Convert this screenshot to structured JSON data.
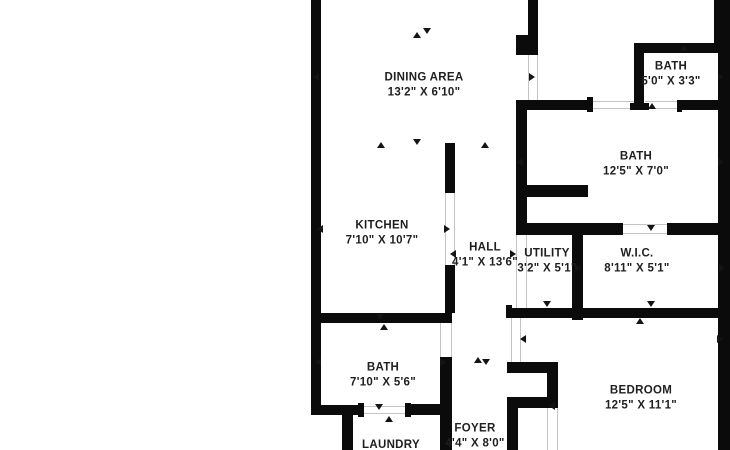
{
  "canvas": {
    "width": 730,
    "height": 450,
    "background": "#ffffff",
    "wall_color": "#0b0b0b",
    "door_line_color": "#c4c4c4",
    "text_color": "#1f1f1f"
  },
  "rooms": [
    {
      "id": "dining-area",
      "name": "DINING AREA",
      "dims": "13'2\" X 6'10\"",
      "cx": 424,
      "cy": 85
    },
    {
      "id": "kitchen",
      "name": "KITCHEN",
      "dims": "7'10\" X 10'7\"",
      "cx": 382,
      "cy": 233
    },
    {
      "id": "hall",
      "name": "HALL",
      "dims": "4'1\" X 13'6\"",
      "cx": 485,
      "cy": 255
    },
    {
      "id": "utility",
      "name": "UTILITY",
      "dims": "3'2\" X 5'1\"",
      "cx": 547,
      "cy": 261
    },
    {
      "id": "wic",
      "name": "W.I.C.",
      "dims": "8'11\" X 5'1\"",
      "cx": 637,
      "cy": 261
    },
    {
      "id": "bath-top-right",
      "name": "BATH",
      "dims": "5'0\" X 3'3\"",
      "cx": 671,
      "cy": 74
    },
    {
      "id": "bath-right",
      "name": "BATH",
      "dims": "12'5\" X 7'0\"",
      "cx": 636,
      "cy": 164
    },
    {
      "id": "bath-left",
      "name": "BATH",
      "dims": "7'10\" X 5'6\"",
      "cx": 383,
      "cy": 375
    },
    {
      "id": "bedroom",
      "name": "BEDROOM",
      "dims": "12'5\" X 11'1\"",
      "cx": 641,
      "cy": 398
    },
    {
      "id": "foyer",
      "name": "FOYER",
      "dims": "4'4\" X 8'0\"",
      "cx": 475,
      "cy": 436
    },
    {
      "id": "laundry",
      "name": "LAUNDRY",
      "dims": "",
      "cx": 391,
      "cy": 445
    }
  ],
  "walls": [
    [
      311,
      0,
      10,
      415
    ],
    [
      311,
      405,
      52,
      10
    ],
    [
      342,
      405,
      11,
      45
    ],
    [
      407,
      404,
      45,
      11
    ],
    [
      440,
      404,
      12,
      46
    ],
    [
      311,
      313,
      141,
      10
    ],
    [
      445,
      143,
      10,
      50
    ],
    [
      445,
      265,
      10,
      48
    ],
    [
      440,
      357,
      12,
      48
    ],
    [
      528,
      0,
      10,
      55
    ],
    [
      516,
      35,
      22,
      20
    ],
    [
      516,
      100,
      75,
      10
    ],
    [
      634,
      43,
      10,
      67
    ],
    [
      634,
      43,
      96,
      10
    ],
    [
      714,
      0,
      16,
      53
    ],
    [
      718,
      0,
      12,
      450
    ],
    [
      682,
      100,
      48,
      10
    ],
    [
      516,
      100,
      11,
      135
    ],
    [
      518,
      185,
      70,
      12
    ],
    [
      516,
      223,
      107,
      12
    ],
    [
      667,
      223,
      63,
      12
    ],
    [
      572,
      223,
      11,
      97
    ],
    [
      511,
      308,
      219,
      10
    ],
    [
      507,
      362,
      51,
      11
    ],
    [
      547,
      362,
      11,
      46
    ],
    [
      507,
      397,
      51,
      11
    ],
    [
      507,
      397,
      11,
      53
    ],
    [
      587,
      97,
      6,
      15
    ],
    [
      630,
      103,
      19,
      7
    ],
    [
      677,
      100,
      5,
      12
    ],
    [
      358,
      403,
      6,
      14
    ],
    [
      405,
      403,
      6,
      14
    ],
    [
      506,
      305,
      6,
      13
    ]
  ],
  "door_openings": [
    [
      528,
      55,
      10,
      45,
      "v"
    ],
    [
      591,
      101,
      44,
      8,
      "h"
    ],
    [
      645,
      101,
      37,
      8,
      "h"
    ],
    [
      445,
      193,
      10,
      72,
      "v"
    ],
    [
      516,
      235,
      11,
      73,
      "v"
    ],
    [
      623,
      224,
      44,
      10,
      "h"
    ],
    [
      440,
      323,
      12,
      34,
      "v"
    ],
    [
      363,
      406,
      44,
      8,
      "h"
    ],
    [
      511,
      318,
      10,
      44,
      "v"
    ],
    [
      547,
      408,
      11,
      42,
      "v"
    ]
  ],
  "markers": [
    [
      417,
      35,
      "up"
    ],
    [
      427,
      31,
      "down"
    ],
    [
      316,
      77,
      "left"
    ],
    [
      532,
      77,
      "right"
    ],
    [
      381,
      145,
      "up"
    ],
    [
      417,
      142,
      "down"
    ],
    [
      485,
      145,
      "up"
    ],
    [
      320,
      229,
      "left"
    ],
    [
      447,
      229,
      "right"
    ],
    [
      453,
      254,
      "left"
    ],
    [
      513,
      254,
      "right"
    ],
    [
      578,
      268,
      "right"
    ],
    [
      722,
      268,
      "right"
    ],
    [
      651,
      228,
      "down"
    ],
    [
      652,
      106,
      "up"
    ],
    [
      520,
      162,
      "left"
    ],
    [
      721,
      162,
      "right"
    ],
    [
      684,
      48,
      "up"
    ],
    [
      721,
      77,
      "right"
    ],
    [
      318,
      362,
      "left"
    ],
    [
      443,
      362,
      "right"
    ],
    [
      380,
      317,
      "down"
    ],
    [
      384,
      327,
      "up"
    ],
    [
      379,
      407,
      "down"
    ],
    [
      389,
      419,
      "up"
    ],
    [
      478,
      360,
      "up"
    ],
    [
      486,
      362,
      "down"
    ],
    [
      547,
      304,
      "down"
    ],
    [
      651,
      304,
      "down"
    ],
    [
      640,
      321,
      "up"
    ],
    [
      523,
      339,
      "left"
    ],
    [
      720,
      339,
      "right"
    ],
    [
      552,
      406,
      "left"
    ]
  ]
}
